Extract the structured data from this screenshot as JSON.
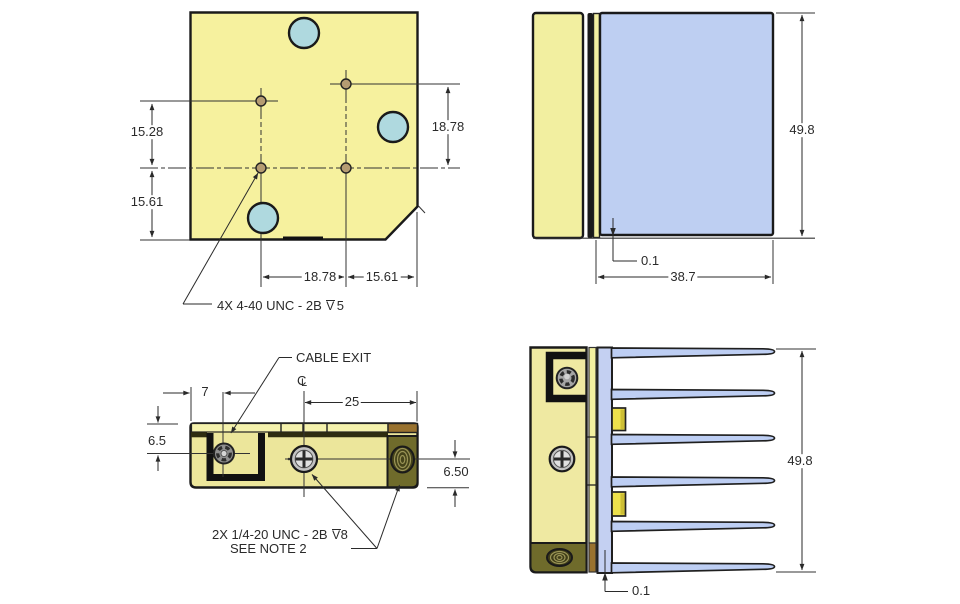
{
  "drawing": {
    "title": "heatsink-assembly-engineering-drawing",
    "colors": {
      "outline": "#1a1a1a",
      "thin_line": "#333333",
      "plate_yellow": "#F6F19E",
      "strip_yellow": "#F4F1AC",
      "front_body_yellow": "#ECE69B",
      "cyan_hole": "#AFD9DF",
      "blue_block": "#BECFF2",
      "fin_blue": "#BDCEF3",
      "spine_blue": "#C4D0F2",
      "olive_block": "#6F6B2B",
      "olive_hole": "#45431A",
      "thread_line": "#9A9456",
      "brown": "#99722F",
      "tab_yellow": "#EDE14C",
      "small_hole_tan": "#B59C72",
      "screw_gray": "#C2C2C2"
    },
    "views": {
      "top": {
        "dims": {
          "v_upper": "15.28",
          "v_lower": "15.61",
          "v_right": "18.78",
          "h_left": "18.78",
          "h_right": "15.61"
        },
        "thread_note": {
          "prefix": "4X 4-40 UNC  - 2B",
          "depth_letter": "V",
          "value": "5"
        }
      },
      "side": {
        "dims": {
          "height": "49.8",
          "step": "0.1",
          "width": "38.7"
        }
      },
      "front": {
        "cable_exit_label": "CABLE EXIT",
        "centerline": {
          "c": "C",
          "l": "L"
        },
        "dims": {
          "offset": "7",
          "left_height": "6.5",
          "half_width": "25",
          "right_height": "6.50"
        },
        "thread_note": {
          "prefix": "2X 1/4-20 UNC - 2B",
          "depth_letter": "V",
          "value": "8",
          "line2": "SEE NOTE 2"
        }
      },
      "side_fins": {
        "dims": {
          "height": "49.8",
          "step": "0.1"
        }
      }
    }
  }
}
